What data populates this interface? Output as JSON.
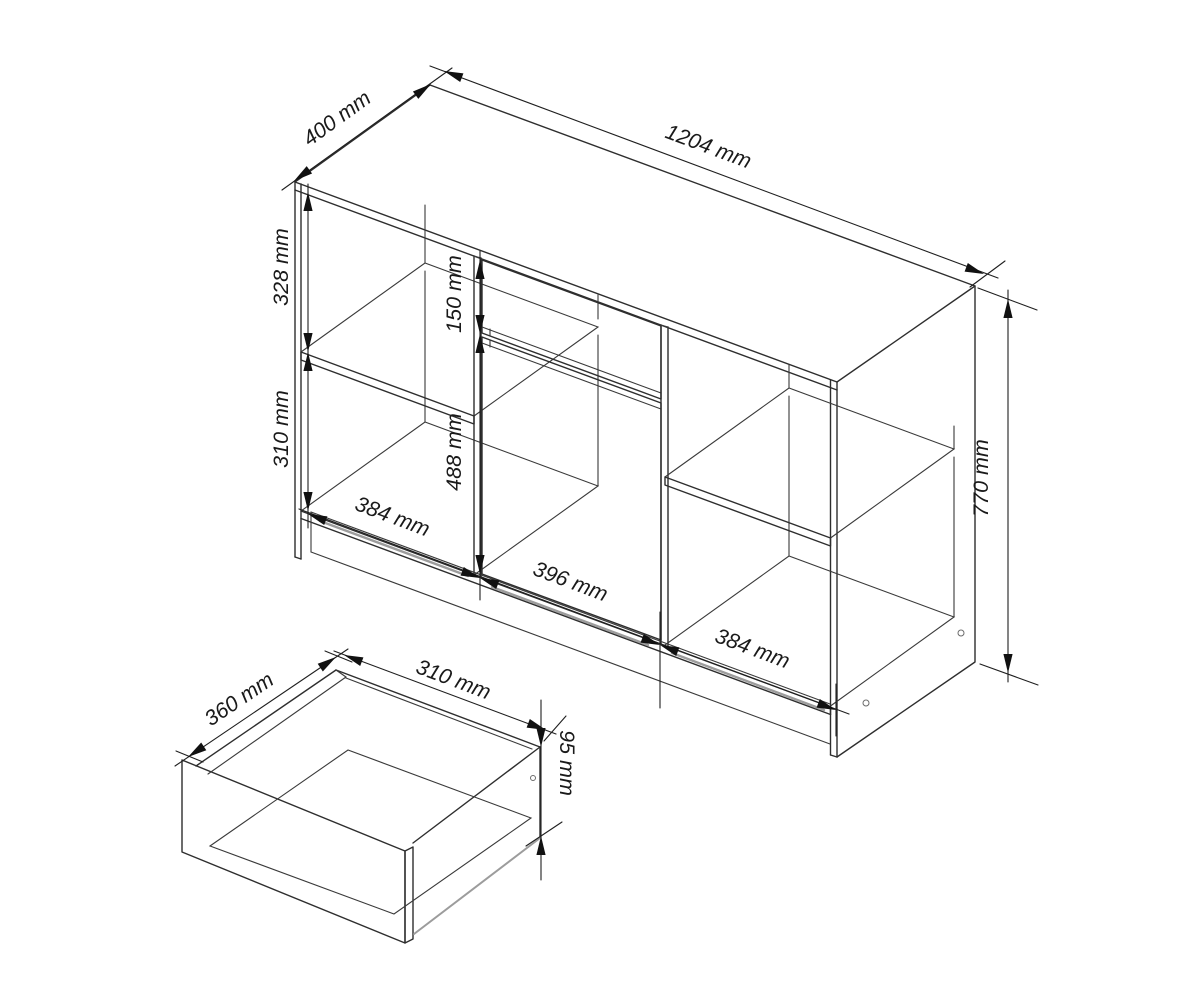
{
  "drawing": {
    "kind": "furniture-technical-dimension-diagram",
    "units": "mm",
    "views": {
      "main": "sideboard cabinet, axonometric view",
      "detail": "pulled-out drawer box, axonometric view"
    },
    "labels": {
      "cabinet_depth": "400 mm",
      "cabinet_width": "1204 mm",
      "left_upper_opening": "328 mm",
      "left_lower_opening": "310 mm",
      "drawer_front_height": "150 mm",
      "door_height": "488 mm",
      "left_section_width": "384 mm",
      "center_section_width": "396 mm",
      "right_section_width": "384 mm",
      "cabinet_height": "770 mm",
      "drawer_depth": "360 mm",
      "drawer_width": "310 mm",
      "drawer_height": "95 mm"
    },
    "dimensions_mm": {
      "cabinet": {
        "width": 1204,
        "depth": 400,
        "height": 770,
        "left_upper_opening": 328,
        "left_lower_opening": 310,
        "drawer_front_height": 150,
        "door_height": 488,
        "left_section_width": 384,
        "center_section_width": 396,
        "right_section_width": 384
      },
      "drawer": {
        "depth": 360,
        "width": 310,
        "height": 95
      }
    },
    "colors": {
      "background": "#ffffff",
      "line": "#2e2e2e",
      "muted_line": "#9c9c9c"
    }
  }
}
